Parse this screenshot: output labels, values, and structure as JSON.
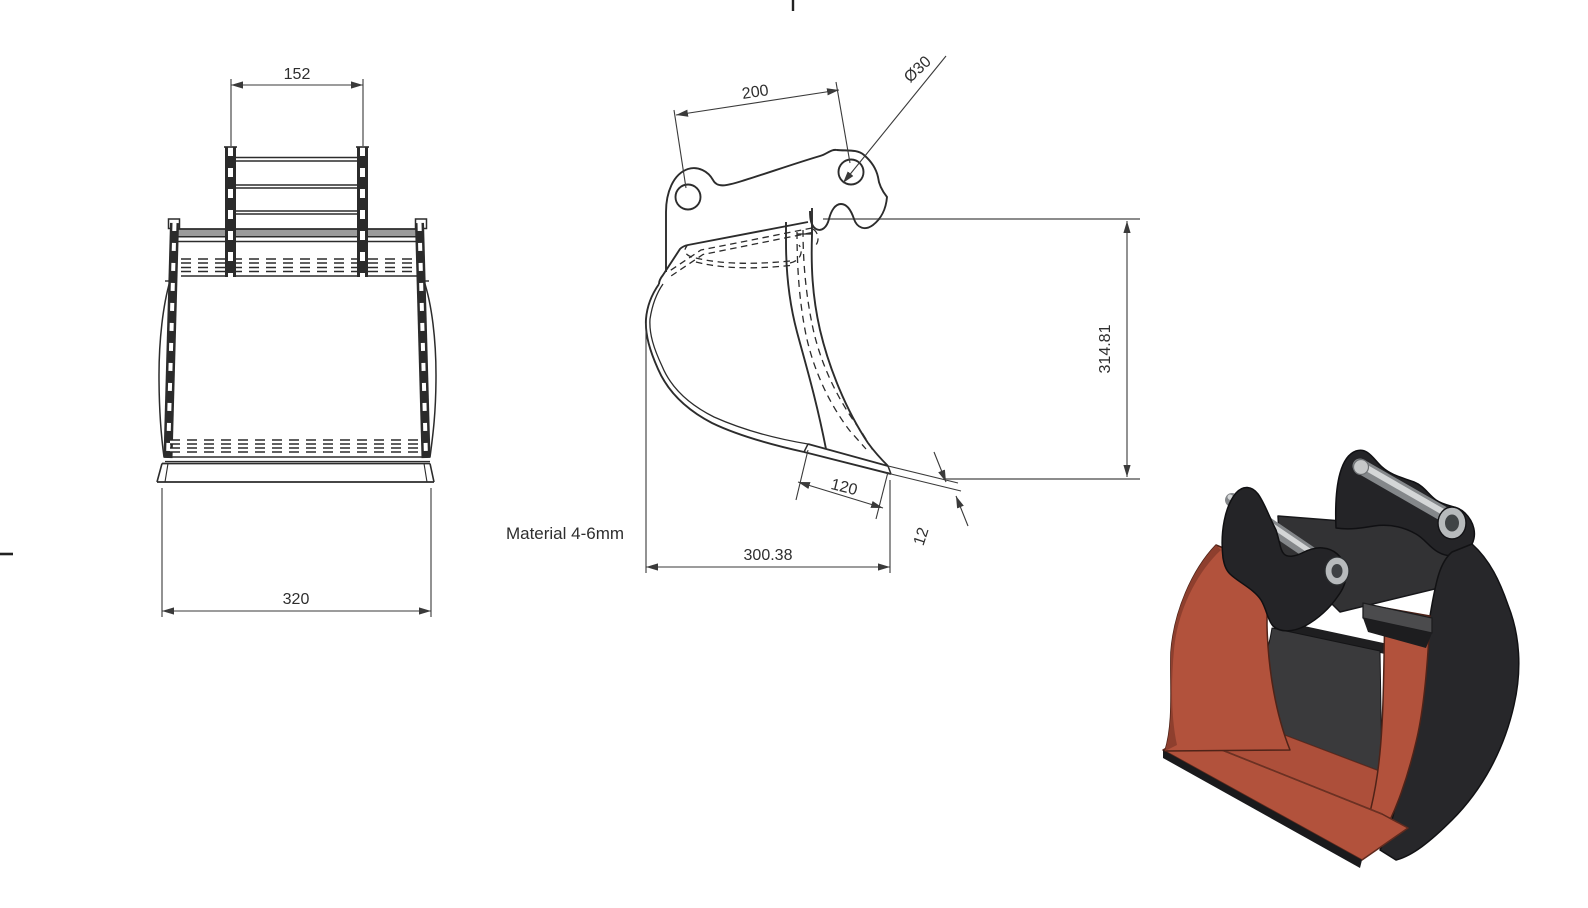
{
  "drawing": {
    "material_note": "Material 4-6mm",
    "dims": {
      "bracket_inner_width": "152",
      "bucket_bottom_width": "320",
      "pin_spacing": "200",
      "pin_hole_diameter": "Ø30",
      "overall_height": "314.81",
      "cutting_edge_length": "120",
      "cutting_edge_thickness": "12",
      "overall_depth": "300.38"
    }
  },
  "colors": {
    "object_line": "#2c2c2c",
    "dim_line": "#3a3a3a",
    "ext_gray": "#8c8c8c",
    "tube_gray": "#9b9b9b",
    "render_body_dark": "#242427",
    "render_shell": "#27272a",
    "render_deck": "#323234",
    "render_floor": "#3a3a3c",
    "render_red_main": "#b2523c",
    "render_red_floor": "#ad4f3a",
    "render_red_dark": "#8e3f2e",
    "render_pin_base": "#84878a",
    "render_pin_highlight": "#d4d6d7",
    "render_hole_ring": "#b7babc"
  }
}
